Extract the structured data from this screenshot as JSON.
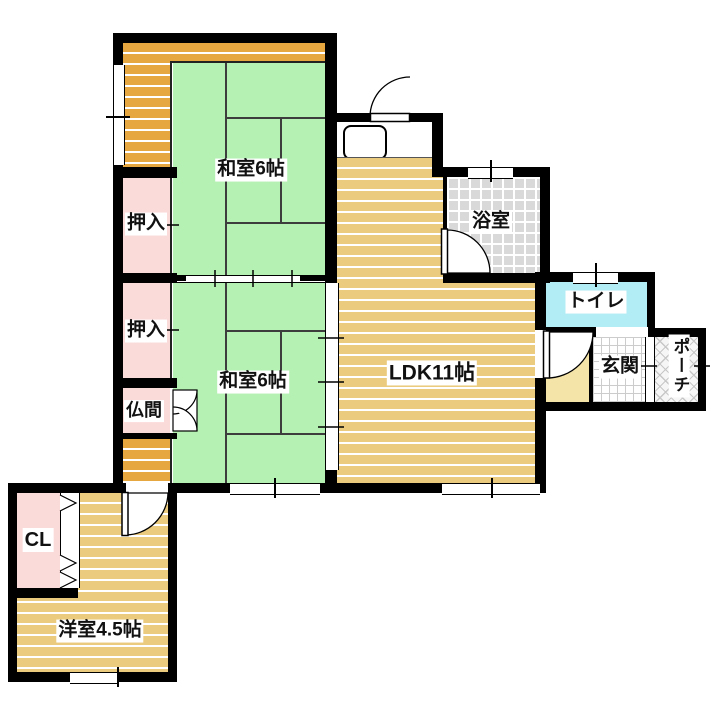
{
  "floorplan": {
    "rooms": {
      "washitsu1": {
        "label": "和室6帖"
      },
      "washitsu2": {
        "label": "和室6帖"
      },
      "oshiire1": {
        "label": "押入"
      },
      "oshiire2": {
        "label": "押入"
      },
      "butsuma": {
        "label": "仏間"
      },
      "ldk": {
        "label": "LDK11帖"
      },
      "bathroom": {
        "label": "浴室"
      },
      "toilet": {
        "label": "トイレ"
      },
      "genkan": {
        "label": "玄関"
      },
      "porch": {
        "label": "ポーチ"
      },
      "closet": {
        "label": "CL"
      },
      "youshitsu": {
        "label": "洋室4.5帖"
      }
    },
    "colors": {
      "wall": "#000000",
      "tatami_green": "#b6f1b4",
      "wood_tan": "#ebcb7e",
      "engawa_orange": "#e6a640",
      "closet_pink": "#fbdada",
      "bath_gray": "#d9d9d9",
      "toilet_cyan": "#b2ecf5",
      "hall_cream": "#f5e4a8"
    }
  }
}
